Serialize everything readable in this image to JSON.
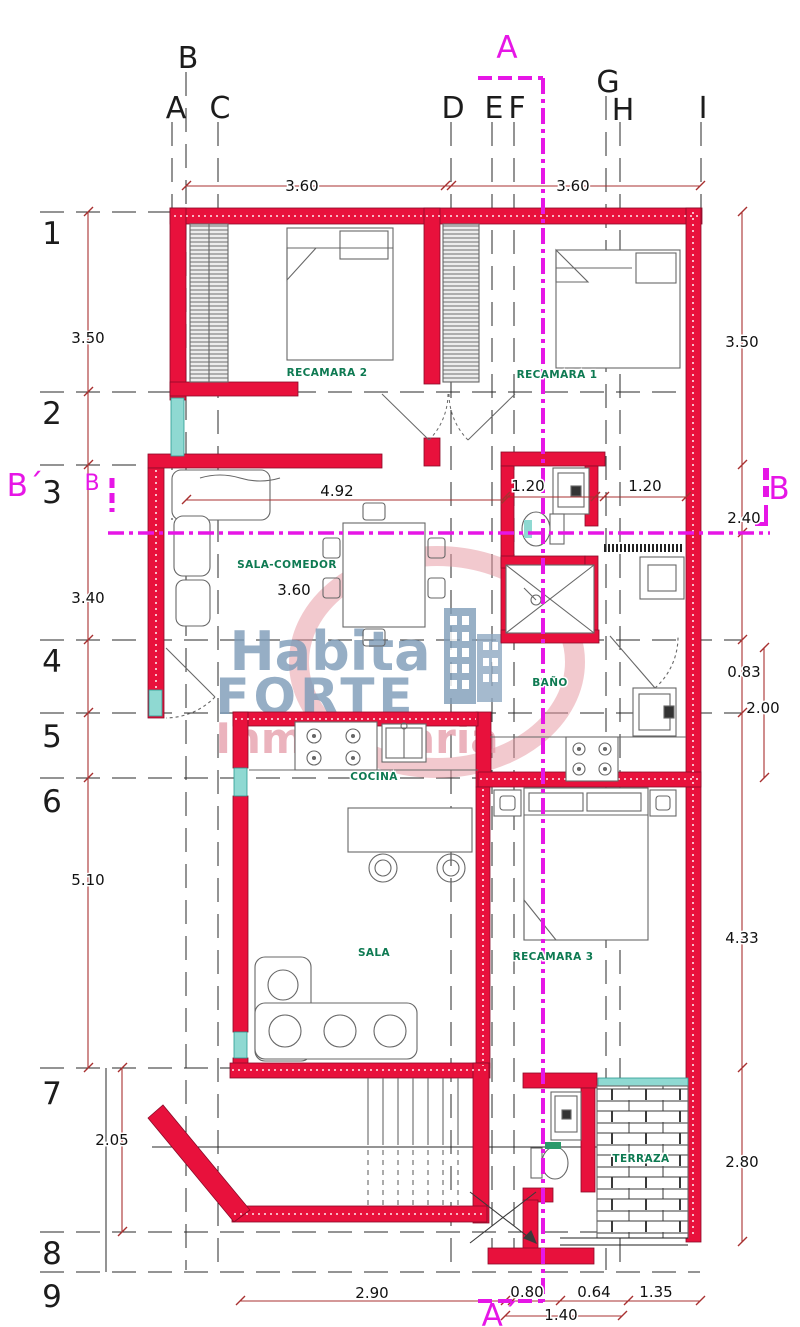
{
  "grid": {
    "cols": [
      {
        "label": "B"
      },
      {
        "label": "A"
      },
      {
        "label": "C"
      },
      {
        "label": "D"
      },
      {
        "label": "E"
      },
      {
        "label": "F"
      },
      {
        "label": "G"
      },
      {
        "label": "H"
      },
      {
        "label": "I"
      }
    ],
    "rows": [
      {
        "label": "1"
      },
      {
        "label": "2"
      },
      {
        "label": "3"
      },
      {
        "label": "4"
      },
      {
        "label": "5"
      },
      {
        "label": "6"
      },
      {
        "label": "7"
      },
      {
        "label": "8"
      },
      {
        "label": "9"
      }
    ]
  },
  "sections": {
    "top": "A",
    "bottom": "A´",
    "left_big": "B´",
    "left_small": "B",
    "right": "B"
  },
  "dims": {
    "top": [
      {
        "text": "3.60"
      },
      {
        "text": "3.60"
      }
    ],
    "left": [
      {
        "text": "3.50"
      },
      {
        "text": "3.40"
      },
      {
        "text": "5.10"
      },
      {
        "text": "2.05"
      }
    ],
    "right": [
      {
        "text": "3.50"
      },
      {
        "text": "2.40"
      },
      {
        "text": "0.83"
      },
      {
        "text": "2.00"
      },
      {
        "text": "4.33"
      },
      {
        "text": "2.80"
      }
    ],
    "middle": [
      {
        "text": "4.92"
      },
      {
        "text": "1.20"
      },
      {
        "text": "1.20"
      },
      {
        "text": "3.60"
      }
    ],
    "bottom": [
      {
        "text": "2.90"
      },
      {
        "text": "0.80"
      },
      {
        "text": "0.64"
      },
      {
        "text": "1.35"
      },
      {
        "text": "1.40"
      }
    ]
  },
  "rooms": [
    {
      "name": "RECAMARA 2"
    },
    {
      "name": "RECAMARA 1"
    },
    {
      "name": "SALA-COMEDOR"
    },
    {
      "name": "BAÑO"
    },
    {
      "name": "COCINA"
    },
    {
      "name": "SALA"
    },
    {
      "name": "RECAMARA 3"
    },
    {
      "name": "TERRAZA"
    }
  ],
  "watermark": {
    "word1": "Habita",
    "word2": "FORTE",
    "word3": "Inmobiliaria"
  },
  "colors": {
    "wall": "#e8113c",
    "section": "#e616e6",
    "dimension": "#a83030",
    "room_label": "#0e7a52",
    "window": "#8fd9d2",
    "watermark_blue": "#7f9db9",
    "watermark_pink": "#e59aa8"
  }
}
